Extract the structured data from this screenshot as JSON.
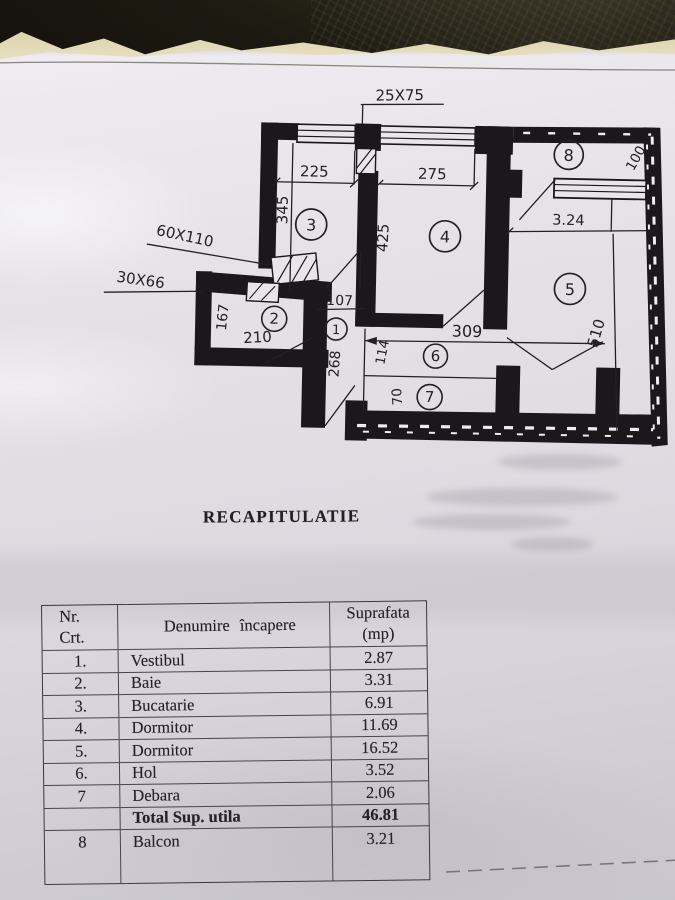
{
  "heading": "RECAPITULATIE",
  "table": {
    "headers": {
      "nr_line1": "Nr.",
      "nr_line2": "Crt.",
      "name": "Denumire încapere",
      "area_line1": "Suprafata",
      "area_line2": "(mp)"
    },
    "rows": [
      {
        "nr": "1.",
        "name": "Vestibul",
        "area": "2.87"
      },
      {
        "nr": "2.",
        "name": "Baie",
        "area": "3.31"
      },
      {
        "nr": "3.",
        "name": "Bucatarie",
        "area": "6.91"
      },
      {
        "nr": "4.",
        "name": "Dormitor",
        "area": "11.69"
      },
      {
        "nr": "5.",
        "name": "Dormitor",
        "area": "16.52"
      },
      {
        "nr": "6.",
        "name": "Hol",
        "area": "3.52"
      },
      {
        "nr": "7",
        "name": "Debara",
        "area": "2.06"
      },
      {
        "nr": "",
        "name": "Total Sup. utila",
        "area": "46.81"
      },
      {
        "nr": "8",
        "name": "Balcon",
        "area": "3.21"
      }
    ]
  },
  "plan": {
    "window_sizes": {
      "top": "25X75",
      "kitchen": "60X110",
      "bath": "30X66"
    },
    "room_numbers": {
      "r1": "1",
      "r2": "2",
      "r3": "3",
      "r4": "4",
      "r5": "5",
      "r6": "6",
      "r7": "7",
      "r8": "8"
    },
    "dims": {
      "w225": "225",
      "w275": "275",
      "h345": "345",
      "h425": "425",
      "w324": "3.24",
      "h100": "100",
      "h510": "510",
      "w107": "107",
      "w210": "210",
      "h167": "167",
      "h268": "268",
      "w309": "309",
      "h114": "114",
      "h70": "70"
    }
  },
  "colors": {
    "paper": "#e3e0e6",
    "background": "#1b1910",
    "under_sheet": "#e6ddbd",
    "ink": "#1a181a"
  }
}
